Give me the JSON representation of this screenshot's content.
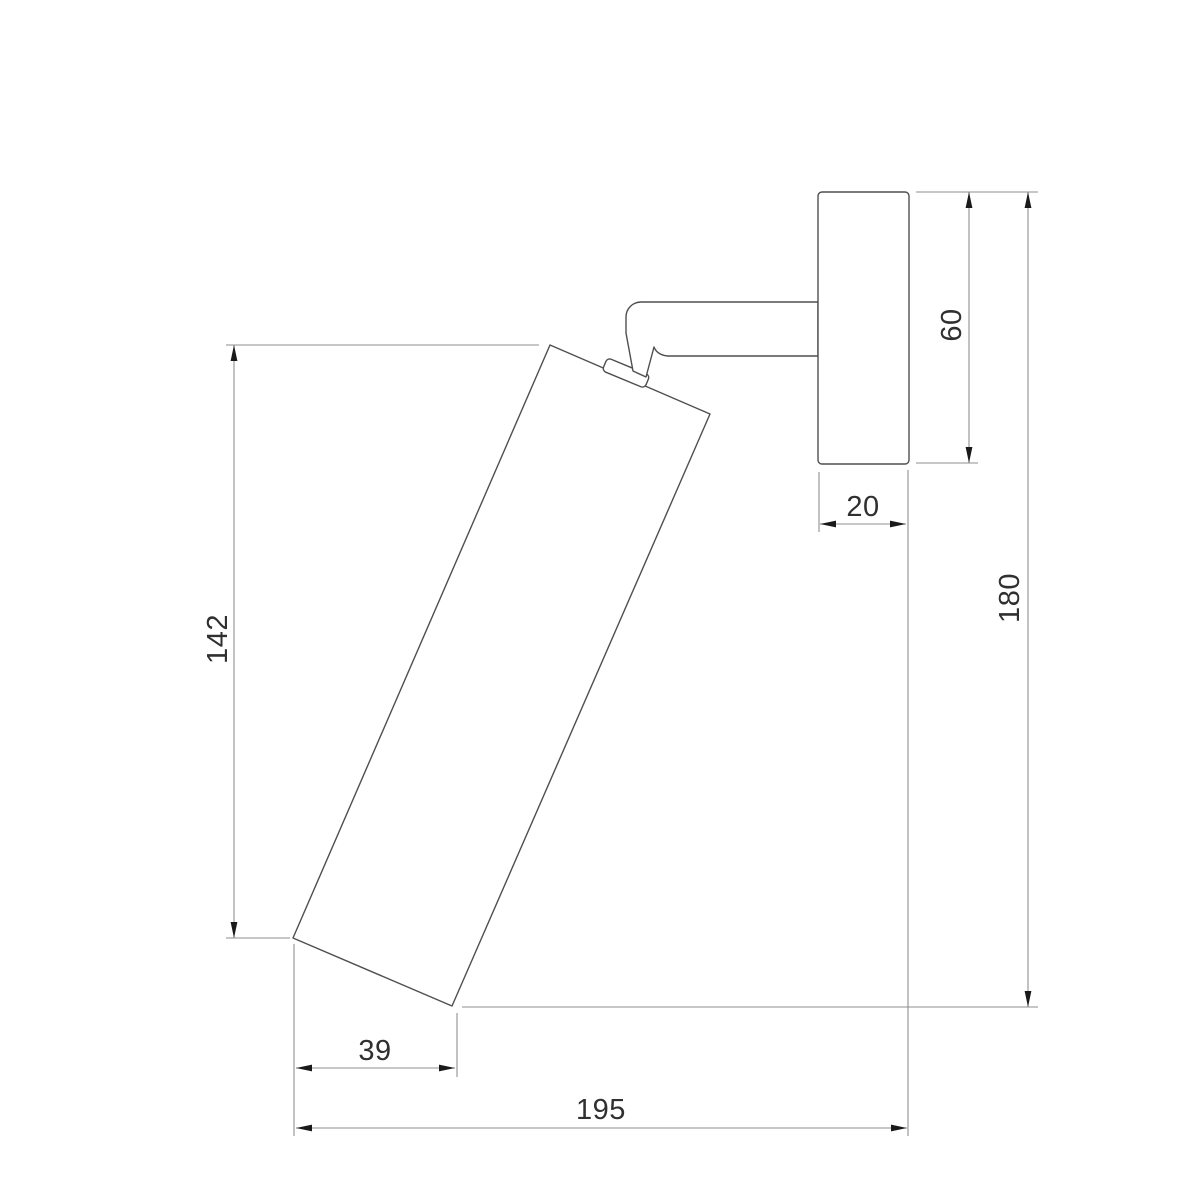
{
  "drawing": {
    "title": "Wall spotlight side-view dimension drawing",
    "background_color": "#ffffff",
    "colors": {
      "object_outline": "#4f4f4f",
      "dimension_lines": "#8f8f8f",
      "arrowheads": "#1a1a1a",
      "label_text": "#303030"
    },
    "dimensions": {
      "body_length": "142",
      "body_bottom_offset": "39",
      "overall_depth": "195",
      "backplate_depth": "20",
      "backplate_height": "60",
      "overall_height": "180"
    }
  }
}
